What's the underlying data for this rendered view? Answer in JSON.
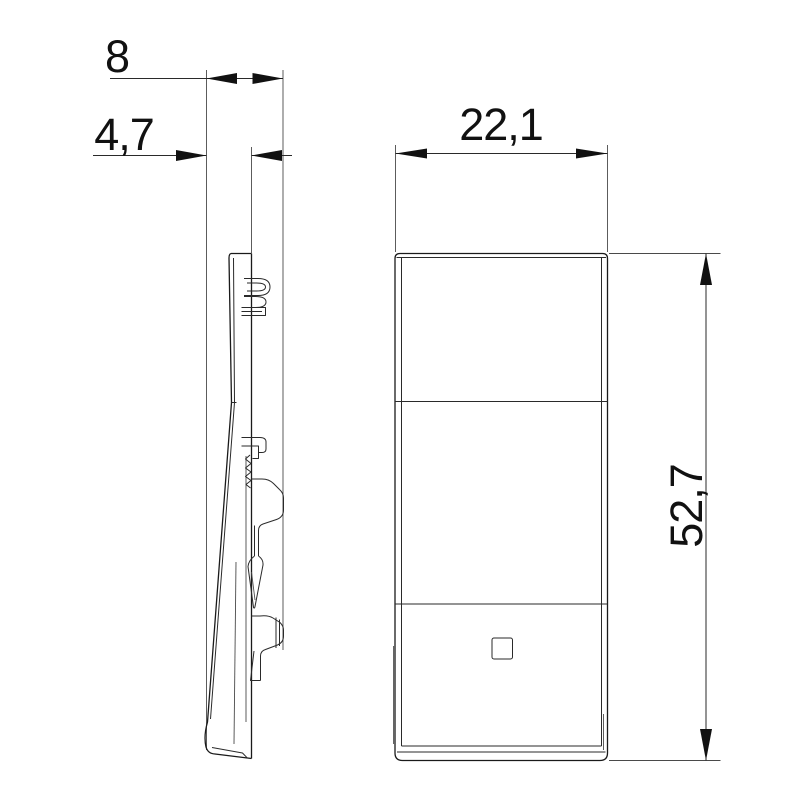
{
  "drawing": {
    "title": "rocker-button-technical-drawing",
    "views": {
      "side_view": "side-profile-view",
      "front_view": "front-view"
    },
    "dimensions": {
      "depth_total": "8",
      "depth_body": "4,7",
      "width": "22,1",
      "height": "52,7"
    },
    "colors": {
      "line": "#2a2a2a",
      "arrow_fill": "#111111",
      "background": "#ffffff"
    }
  }
}
